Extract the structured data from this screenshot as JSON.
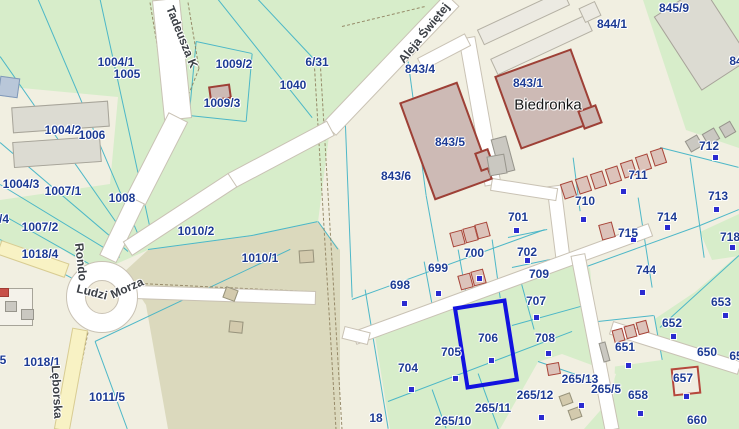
{
  "app": {
    "title_hidden": "",
    "selected_parcel": "706"
  },
  "colors": {
    "base": "#f1efe1",
    "green": "#d7edca",
    "olive": "#dbd9bd",
    "road_fill": "#ffffff",
    "road_casing": "#c9c2b4",
    "yellow_road_fill": "#f8f2c4",
    "yellow_road_casing": "#d8cc92",
    "parcel_line": "#45b4c6",
    "dashed_path": "#8f815f",
    "label": "#1d3b94",
    "highlight": "#1212df",
    "dot": "#2b2bd0"
  },
  "areas": [
    {
      "n": "green-top-left",
      "f": "green",
      "p": [
        [
          0,
          0
        ],
        [
          445,
          0
        ],
        [
          330,
          128
        ],
        [
          318,
          222
        ],
        [
          252,
          236
        ],
        [
          148,
          250
        ],
        [
          98,
          272
        ],
        [
          60,
          248
        ],
        [
          0,
          255
        ]
      ]
    },
    {
      "n": "warehouse-yard",
      "f": "base",
      "p": [
        [
          0,
          86
        ],
        [
          118,
          97
        ],
        [
          110,
          184
        ],
        [
          0,
          200
        ]
      ]
    },
    {
      "n": "olive-field",
      "f": "olive",
      "p": [
        [
          148,
          250
        ],
        [
          252,
          236
        ],
        [
          318,
          222
        ],
        [
          340,
          250
        ],
        [
          340,
          429
        ],
        [
          168,
          429
        ],
        [
          146,
          305
        ],
        [
          124,
          272
        ]
      ]
    },
    {
      "n": "green-top-right",
      "f": "green",
      "p": [
        [
          643,
          0
        ],
        [
          739,
          0
        ],
        [
          739,
          148
        ],
        [
          686,
          130
        ]
      ]
    },
    {
      "n": "green-bottom-mid",
      "f": "green",
      "p": [
        [
          355,
          342
        ],
        [
          572,
          260
        ],
        [
          590,
          268
        ],
        [
          604,
          429
        ],
        [
          355,
          429
        ]
      ]
    },
    {
      "n": "parcel-18-field",
      "f": "base",
      "p": [
        [
          340,
          300
        ],
        [
          368,
          292
        ],
        [
          390,
          429
        ],
        [
          340,
          429
        ]
      ]
    },
    {
      "n": "green-east",
      "f": "green",
      "p": [
        [
          616,
          345
        ],
        [
          695,
          292
        ],
        [
          739,
          254
        ],
        [
          739,
          429
        ],
        [
          612,
          429
        ]
      ]
    },
    {
      "n": "green-718",
      "f": "green",
      "p": [
        [
          700,
          232
        ],
        [
          739,
          214
        ],
        [
          739,
          256
        ],
        [
          712,
          260
        ]
      ]
    },
    {
      "n": "strip-265",
      "f": "base",
      "p": [
        [
          500,
          429
        ],
        [
          538,
          362
        ],
        [
          562,
          354
        ],
        [
          616,
          374
        ],
        [
          606,
          404
        ],
        [
          584,
          429
        ]
      ]
    },
    {
      "n": "parcel-651-field",
      "f": "base",
      "p": [
        [
          598,
          322
        ],
        [
          654,
          316
        ],
        [
          662,
          360
        ],
        [
          604,
          368
        ]
      ]
    }
  ],
  "parcel_lines": [
    [
      0,
      57,
      133,
      247
    ],
    [
      38,
      0,
      141,
      242
    ],
    [
      100,
      0,
      152,
      238
    ],
    [
      0,
      143,
      128,
      252
    ],
    [
      0,
      185,
      120,
      258
    ],
    [
      218,
      0,
      312,
      118
    ],
    [
      258,
      0,
      318,
      64
    ],
    [
      196,
      42,
      252,
      54
    ],
    [
      252,
      54,
      246,
      122
    ],
    [
      196,
      42,
      189,
      116
    ],
    [
      189,
      116,
      246,
      122
    ],
    [
      148,
      250,
      252,
      236
    ],
    [
      252,
      236,
      318,
      222
    ],
    [
      318,
      222,
      338,
      250
    ],
    [
      0,
      214,
      92,
      266
    ],
    [
      0,
      240,
      78,
      282
    ],
    [
      95,
      342,
      290,
      250
    ],
    [
      95,
      342,
      127,
      429
    ],
    [
      403,
      58,
      345,
      118
    ],
    [
      345,
      118,
      352,
      298
    ],
    [
      408,
      62,
      426,
      196
    ],
    [
      426,
      196,
      438,
      262
    ],
    [
      352,
      300,
      545,
      230
    ],
    [
      365,
      290,
      388,
      429
    ],
    [
      388,
      402,
      572,
      332
    ],
    [
      424,
      262,
      434,
      316
    ],
    [
      458,
      250,
      468,
      306
    ],
    [
      492,
      240,
      500,
      298
    ],
    [
      508,
      238,
      547,
      230
    ],
    [
      512,
      268,
      550,
      260
    ],
    [
      573,
      158,
      580,
      212
    ],
    [
      638,
      198,
      652,
      288
    ],
    [
      690,
      158,
      704,
      258
    ],
    [
      660,
      148,
      739,
      168
    ],
    [
      584,
      268,
      700,
      226
    ],
    [
      700,
      226,
      739,
      210
    ],
    [
      660,
      328,
      739,
      256
    ],
    [
      538,
      362,
      608,
      386
    ],
    [
      478,
      374,
      498,
      429
    ],
    [
      432,
      390,
      446,
      429
    ],
    [
      512,
      326,
      584,
      306
    ],
    [
      518,
      272,
      534,
      330
    ],
    [
      598,
      322,
      654,
      316
    ],
    [
      654,
      316,
      662,
      360
    ]
  ],
  "dashed_paths": [
    [
      188,
      2,
      199,
      68
    ],
    [
      199,
      68,
      160,
      166
    ],
    [
      160,
      166,
      112,
      242
    ],
    [
      150,
      2,
      160,
      62
    ],
    [
      314,
      58,
      336,
      429
    ],
    [
      320,
      58,
      342,
      429
    ],
    [
      342,
      26,
      425,
      6
    ],
    [
      88,
      332,
      68,
      429
    ],
    [
      140,
      283,
      308,
      291
    ]
  ],
  "roads": [
    [
      166,
      0,
      178,
      118,
      26,
      "w"
    ],
    [
      178,
      118,
      136,
      200,
      20,
      "w"
    ],
    [
      136,
      200,
      108,
      258,
      17,
      "w"
    ],
    [
      452,
      0,
      330,
      128,
      17,
      "w"
    ],
    [
      330,
      128,
      232,
      180,
      15,
      "w"
    ],
    [
      232,
      180,
      128,
      248,
      15,
      "w"
    ],
    [
      135,
      292,
      315,
      298,
      12,
      "w"
    ],
    [
      0,
      247,
      66,
      270,
      13,
      "y"
    ],
    [
      80,
      330,
      62,
      429,
      14,
      "y"
    ],
    [
      554,
      186,
      563,
      258,
      13,
      "w"
    ],
    [
      355,
      338,
      650,
      230,
      12,
      "w"
    ],
    [
      578,
      255,
      612,
      429,
      13,
      "w"
    ],
    [
      612,
      328,
      739,
      368,
      12,
      "w"
    ],
    [
      344,
      332,
      368,
      338,
      11,
      "w"
    ],
    [
      467,
      38,
      493,
      184,
      15,
      "w"
    ],
    [
      421,
      64,
      467,
      40,
      12,
      "w"
    ],
    [
      492,
      184,
      556,
      194,
      11,
      "w"
    ]
  ],
  "roundabout": {
    "cx": 102,
    "cy": 297,
    "r_outer": 36,
    "r_inner": 17
  },
  "buildings": [
    [
      60,
      117,
      97,
      26,
      -4,
      "gl"
    ],
    [
      57,
      152,
      88,
      26,
      -4,
      "gl"
    ],
    [
      9,
      87,
      20,
      20,
      8,
      "bb"
    ],
    [
      16,
      307,
      34,
      38,
      0,
      "wo"
    ],
    [
      11,
      306,
      12,
      11,
      0,
      "gs"
    ],
    [
      27,
      314,
      13,
      11,
      0,
      "gs"
    ],
    [
      4,
      292,
      10,
      9,
      0,
      "rs"
    ],
    [
      220,
      92,
      22,
      15,
      -8,
      "rt"
    ],
    [
      523,
      17,
      95,
      17,
      -25,
      "wb"
    ],
    [
      541,
      45,
      105,
      18,
      -25,
      "wb"
    ],
    [
      590,
      12,
      18,
      16,
      -25,
      "wb"
    ],
    [
      446,
      141,
      62,
      104,
      -20,
      "rt"
    ],
    [
      546,
      99,
      82,
      78,
      -20,
      "rt"
    ],
    [
      590,
      117,
      20,
      20,
      -20,
      "rt"
    ],
    [
      484,
      160,
      15,
      20,
      -20,
      "rt"
    ],
    [
      503,
      155,
      16,
      36,
      -15,
      "gs"
    ],
    [
      497,
      165,
      18,
      20,
      -10,
      "gs"
    ],
    [
      702,
      38,
      58,
      88,
      -33,
      "gl"
    ],
    [
      694,
      143,
      14,
      13,
      -30,
      "gs"
    ],
    [
      711,
      136,
      14,
      13,
      -30,
      "gs"
    ],
    [
      727,
      129,
      13,
      13,
      -30,
      "gs"
    ],
    [
      568,
      190,
      13,
      16,
      -18,
      "gr"
    ],
    [
      583,
      185,
      13,
      16,
      -18,
      "gr"
    ],
    [
      598,
      180,
      13,
      16,
      -18,
      "gr"
    ],
    [
      613,
      175,
      13,
      16,
      -18,
      "gr"
    ],
    [
      628,
      169,
      13,
      16,
      -18,
      "gr"
    ],
    [
      643,
      163,
      13,
      16,
      -18,
      "gr"
    ],
    [
      658,
      157,
      13,
      16,
      -18,
      "gr"
    ],
    [
      457,
      238,
      13,
      15,
      -15,
      "gr"
    ],
    [
      470,
      234,
      13,
      15,
      -15,
      "gr"
    ],
    [
      482,
      230,
      13,
      15,
      -15,
      "gr"
    ],
    [
      465,
      281,
      13,
      15,
      -15,
      "gr"
    ],
    [
      478,
      277,
      13,
      15,
      -15,
      "gr"
    ],
    [
      607,
      231,
      14,
      16,
      -15,
      "gr"
    ],
    [
      618,
      335,
      11,
      13,
      -15,
      "gr"
    ],
    [
      630,
      331,
      11,
      13,
      -15,
      "gr"
    ],
    [
      642,
      327,
      11,
      13,
      -15,
      "gr"
    ],
    [
      604,
      352,
      7,
      20,
      -15,
      "gs"
    ],
    [
      553,
      369,
      13,
      12,
      -10,
      "gr"
    ],
    [
      230,
      294,
      13,
      12,
      20,
      "tn"
    ],
    [
      236,
      327,
      14,
      12,
      6,
      "tn"
    ],
    [
      306,
      256,
      15,
      13,
      -4,
      "tn"
    ],
    [
      566,
      399,
      12,
      11,
      -20,
      "tn"
    ],
    [
      575,
      413,
      12,
      11,
      -20,
      "tn"
    ],
    [
      686,
      381,
      28,
      28,
      -6,
      "ho"
    ]
  ],
  "highlight": {
    "x": 486,
    "y": 344,
    "w": 54,
    "h": 84,
    "r": -9
  },
  "address_dots": [
    [
      404,
      303
    ],
    [
      438,
      293
    ],
    [
      479,
      278
    ],
    [
      516,
      230
    ],
    [
      527,
      260
    ],
    [
      583,
      219
    ],
    [
      623,
      191
    ],
    [
      715,
      157
    ],
    [
      716,
      209
    ],
    [
      667,
      227
    ],
    [
      732,
      247
    ],
    [
      642,
      292
    ],
    [
      536,
      317
    ],
    [
      548,
      353
    ],
    [
      491,
      360
    ],
    [
      455,
      378
    ],
    [
      411,
      389
    ],
    [
      541,
      417
    ],
    [
      581,
      405
    ],
    [
      628,
      365
    ],
    [
      673,
      336
    ],
    [
      725,
      315
    ],
    [
      686,
      396
    ],
    [
      640,
      413
    ],
    [
      633,
      239
    ]
  ],
  "parcel_labels": [
    {
      "t": "1004/1",
      "x": 116,
      "y": 62
    },
    {
      "t": "1005",
      "x": 127,
      "y": 74
    },
    {
      "t": "1009/2",
      "x": 234,
      "y": 64
    },
    {
      "t": "1009/3",
      "x": 222,
      "y": 103
    },
    {
      "t": "1004/2",
      "x": 63,
      "y": 130
    },
    {
      "t": "1006",
      "x": 92,
      "y": 135
    },
    {
      "t": "1004/3",
      "x": 21,
      "y": 184
    },
    {
      "t": "1007/1",
      "x": 63,
      "y": 191
    },
    {
      "t": "1008",
      "x": 122,
      "y": 198
    },
    {
      "t": "6/31",
      "x": 317,
      "y": 62
    },
    {
      "t": "1040",
      "x": 293,
      "y": 85
    },
    {
      "t": "843/4",
      "x": 420,
      "y": 69
    },
    {
      "t": "843/5",
      "x": 450,
      "y": 142
    },
    {
      "t": "843/6",
      "x": 396,
      "y": 176
    },
    {
      "t": "843/1",
      "x": 528,
      "y": 83
    },
    {
      "t": "844/1",
      "x": 612,
      "y": 24
    },
    {
      "t": "845/9",
      "x": 674,
      "y": 8
    },
    {
      "t": "1007/2",
      "x": 40,
      "y": 227
    },
    {
      "t": "1018/4",
      "x": 40,
      "y": 254
    },
    {
      "t": "1010/2",
      "x": 196,
      "y": 231
    },
    {
      "t": "1010/1",
      "x": 260,
      "y": 258
    },
    {
      "t": "1018/1",
      "x": 42,
      "y": 362
    },
    {
      "t": "1011/5",
      "x": 107,
      "y": 397
    },
    {
      "t": "698",
      "x": 400,
      "y": 285
    },
    {
      "t": "699",
      "x": 438,
      "y": 268
    },
    {
      "t": "700",
      "x": 474,
      "y": 253
    },
    {
      "t": "701",
      "x": 518,
      "y": 217
    },
    {
      "t": "702",
      "x": 527,
      "y": 252
    },
    {
      "t": "709",
      "x": 539,
      "y": 274
    },
    {
      "t": "710",
      "x": 585,
      "y": 201
    },
    {
      "t": "711",
      "x": 638,
      "y": 175
    },
    {
      "t": "712",
      "x": 709,
      "y": 146
    },
    {
      "t": "713",
      "x": 718,
      "y": 196
    },
    {
      "t": "714",
      "x": 667,
      "y": 217
    },
    {
      "t": "715",
      "x": 628,
      "y": 233
    },
    {
      "t": "718",
      "x": 730,
      "y": 237
    },
    {
      "t": "744",
      "x": 646,
      "y": 270
    },
    {
      "t": "707",
      "x": 536,
      "y": 301
    },
    {
      "t": "708",
      "x": 545,
      "y": 338
    },
    {
      "t": "706",
      "x": 488,
      "y": 338
    },
    {
      "t": "705",
      "x": 451,
      "y": 352
    },
    {
      "t": "704",
      "x": 408,
      "y": 368
    },
    {
      "t": "265/13",
      "x": 580,
      "y": 379
    },
    {
      "t": "265/12",
      "x": 535,
      "y": 395
    },
    {
      "t": "265/11",
      "x": 493,
      "y": 408
    },
    {
      "t": "265/10",
      "x": 453,
      "y": 421
    },
    {
      "t": "18",
      "x": 376,
      "y": 418
    },
    {
      "t": "265/5",
      "x": 606,
      "y": 389
    },
    {
      "t": "658",
      "x": 638,
      "y": 395
    },
    {
      "t": "657",
      "x": 683,
      "y": 378
    },
    {
      "t": "660",
      "x": 697,
      "y": 420
    },
    {
      "t": "651",
      "x": 625,
      "y": 347
    },
    {
      "t": "652",
      "x": 672,
      "y": 323
    },
    {
      "t": "653",
      "x": 721,
      "y": 302
    },
    {
      "t": "650",
      "x": 707,
      "y": 352
    },
    {
      "t": "/4",
      "x": 4,
      "y": 219
    },
    {
      "t": "5",
      "x": 3,
      "y": 360
    },
    {
      "t": "84",
      "x": 736,
      "y": 61
    },
    {
      "t": "65",
      "x": 736,
      "y": 356
    }
  ],
  "street_labels": [
    {
      "t": "Tadeusza K",
      "x": 182,
      "y": 37,
      "r": 68
    },
    {
      "t": "Aleja Świętej",
      "x": 424,
      "y": 33,
      "r": -51
    },
    {
      "t": "Rondo",
      "x": 81,
      "y": 262,
      "r": 84
    },
    {
      "t": "Ludzi",
      "x": 92,
      "y": 292,
      "r": 14
    },
    {
      "t": "Morza",
      "x": 127,
      "y": 288,
      "r": -24
    },
    {
      "t": "Lęborska",
      "x": 57,
      "y": 392,
      "r": 87
    }
  ],
  "poi_labels": [
    {
      "t": "Biedronka",
      "x": 548,
      "y": 105,
      "r": 0
    }
  ]
}
